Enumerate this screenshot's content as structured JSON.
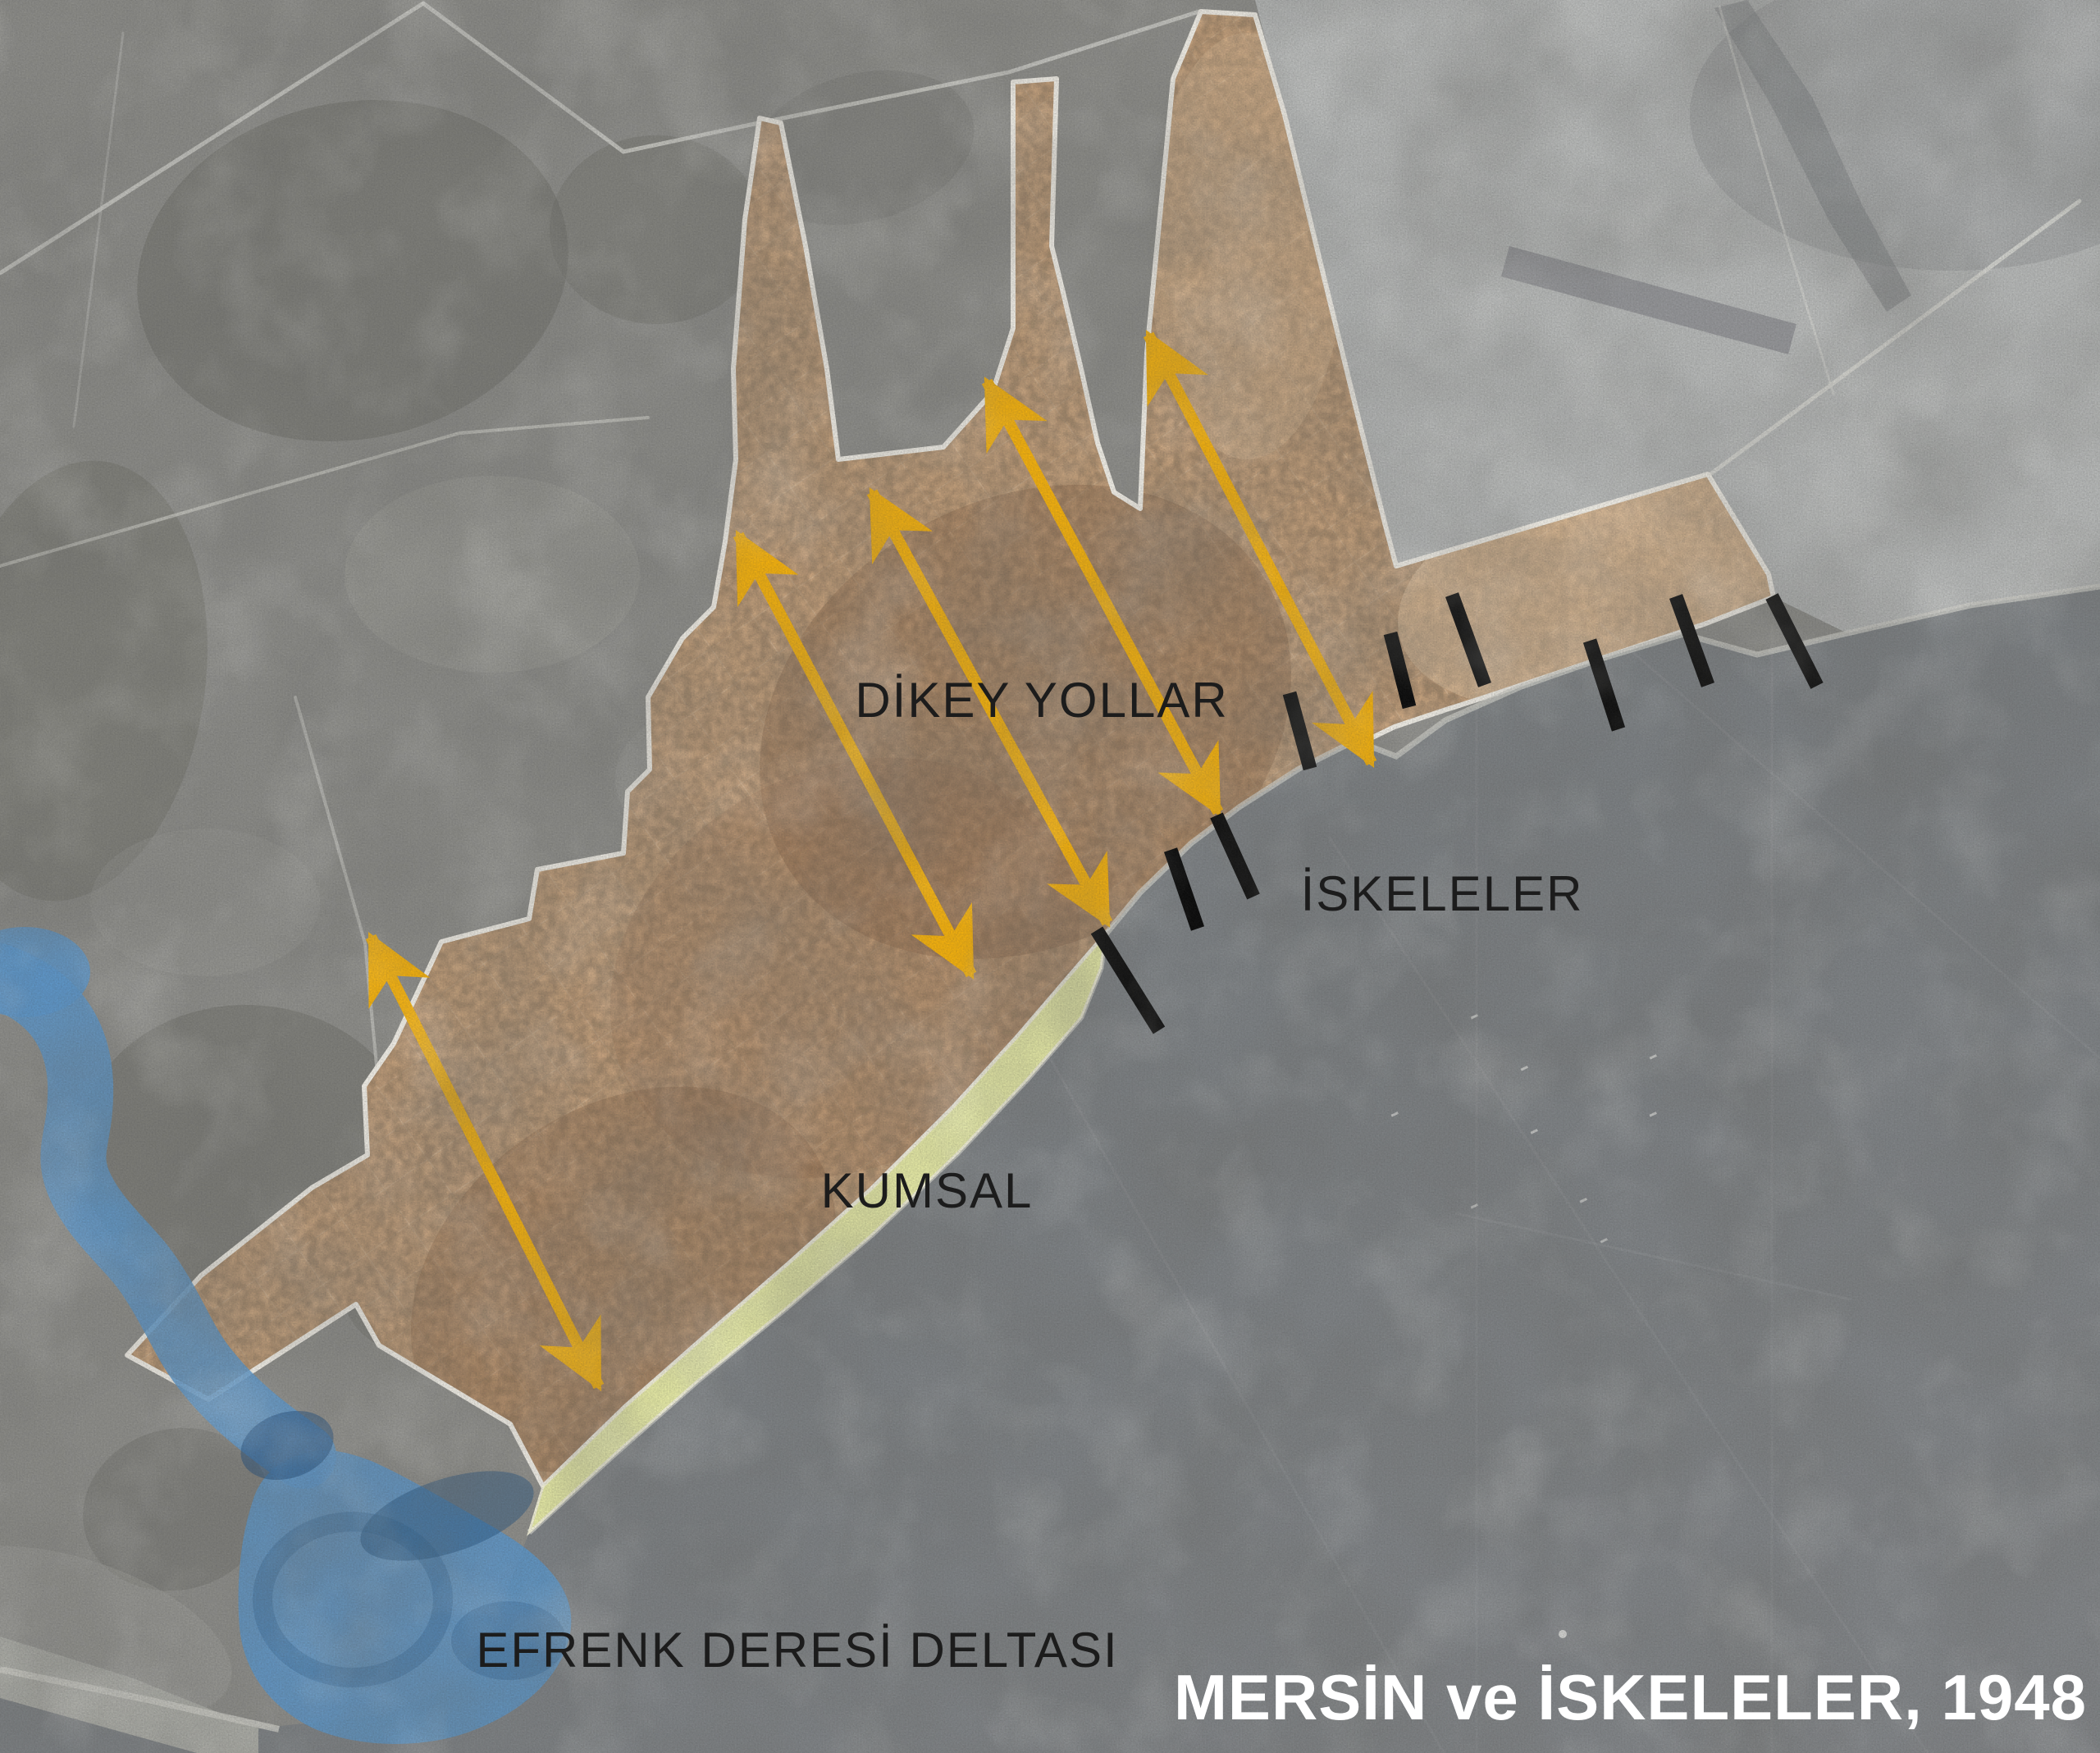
{
  "title": {
    "text": "MERSİN ve İSKELELER, 1948"
  },
  "labels": {
    "vertical_roads": "DİKEY YOLLAR",
    "piers": "İSKELELER",
    "beach": "KUMSAL",
    "delta": "EFRENK DERESİ DELTASI"
  },
  "colors": {
    "arrow": "#F4B10D",
    "pier": "#0a0a0a",
    "city_fill": "#d0a981",
    "city_boundary": "#f2efe7",
    "beach_fill": "#ebefa8",
    "delta_fill": "#5d97c9",
    "sea": "#7e8285",
    "land_nw": "#8e8e8a",
    "land_ne": "#b7b9b8",
    "label_text": "#1c1c1c",
    "title_text": "#ffffff"
  },
  "annotations": {
    "vertical_road_arrows": {
      "count": 5,
      "style": "double-headed",
      "points": [
        [
          452,
          1142,
          730,
          1690
        ],
        [
          900,
          652,
          1184,
          1188
        ],
        [
          1063,
          600,
          1350,
          1125
        ],
        [
          1203,
          465,
          1485,
          990
        ],
        [
          1400,
          408,
          1672,
          930
        ]
      ]
    },
    "pier_marks": {
      "count": 9,
      "points": [
        [
          1337,
          1134,
          1413,
          1256
        ],
        [
          1427,
          1036,
          1460,
          1132
        ],
        [
          1483,
          994,
          1528,
          1093
        ],
        [
          1572,
          845,
          1597,
          937
        ],
        [
          1695,
          772,
          1718,
          862
        ],
        [
          1770,
          725,
          1810,
          835
        ],
        [
          1938,
          781,
          1973,
          889
        ],
        [
          2043,
          727,
          2082,
          835
        ],
        [
          2160,
          727,
          2215,
          836
        ]
      ]
    }
  }
}
